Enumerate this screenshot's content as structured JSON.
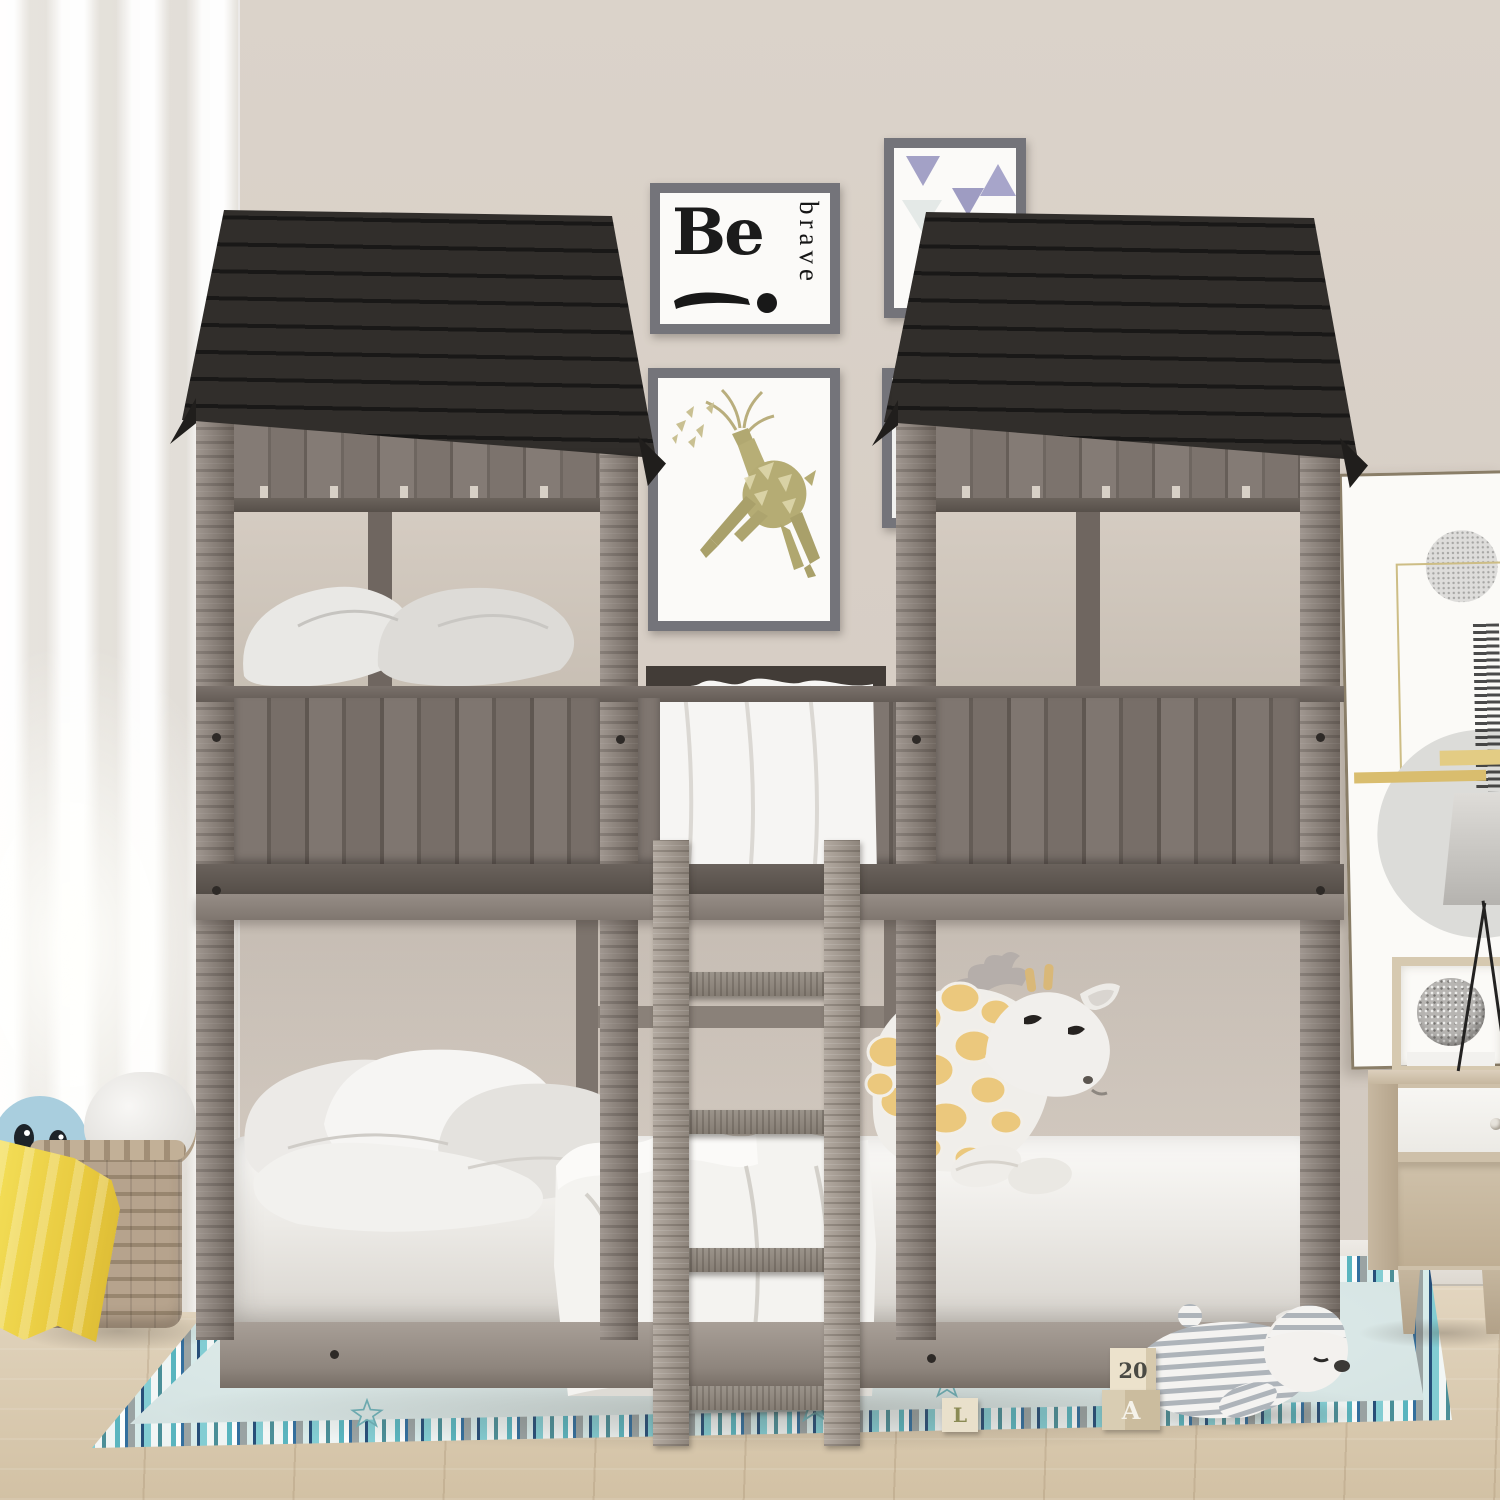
{
  "wall_art": {
    "be_brave_poster": {
      "word_main": "Be",
      "word_vertical": "brave"
    },
    "triangle_poster": {
      "motifs": "three lavender triangles"
    },
    "deer_poster": {
      "motif": "geometric leaping deer"
    }
  },
  "toy_blocks": {
    "number_block": "20",
    "letter_block_a": "A",
    "letter_block_l": "L"
  },
  "palette": {
    "wall": "#d6cdc4",
    "floor_wood": "#d9c9b0",
    "roof_wood": "#262422",
    "bed_wood_gray": "#867d76",
    "rug_field": "#dde9e8",
    "rug_stripe_teal": "#5ab5bf",
    "rug_stripe_blue": "#336f9e",
    "blanket_yellow": "#eed64a",
    "giraffe_spot": "#eac87e",
    "plush_blue": "#a9cede"
  }
}
